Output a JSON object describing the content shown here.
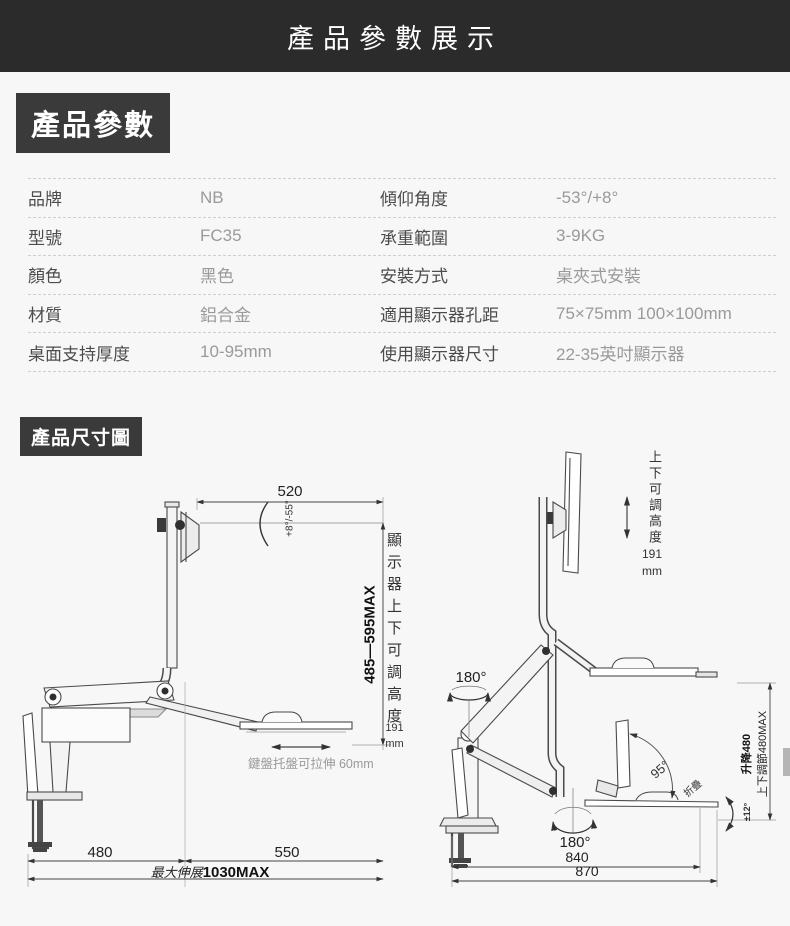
{
  "page": {
    "title": "產品參數展示"
  },
  "sections": {
    "specs_label": "產品參數",
    "dims_label": "產品尺寸圖"
  },
  "specs": {
    "rows": [
      {
        "l1": "品牌",
        "v1": "NB",
        "l2": "傾仰角度",
        "v2": "-53°/+8°"
      },
      {
        "l1": "型號",
        "v1": "FC35",
        "l2": "承重範圍",
        "v2": "3-9KG"
      },
      {
        "l1": "顏色",
        "v1": "黑色",
        "l2": "安裝方式",
        "v2": "桌夾式安裝"
      },
      {
        "l1": "材質",
        "v1": "鋁合金",
        "l2": "適用顯示器孔距",
        "v2": "75×75mm  100×100mm"
      },
      {
        "l1": "桌面支持厚度",
        "v1": "10-95mm",
        "l2": "使用顯示器尺寸",
        "v2": "22-35英吋顯示器"
      }
    ]
  },
  "diagram_left": {
    "dim_top": "520",
    "tilt_angle": "+8°/-55°",
    "height_range": "485—595MAX",
    "height_note": "顯示器上下可調高度",
    "height_value": "191",
    "height_unit": "mm",
    "tray_note": "鍵盤托盤可拉伸 60mm",
    "dim_480": "480",
    "dim_550": "550",
    "max_label": "最大伸展",
    "max_value": "1030MAX"
  },
  "diagram_right": {
    "height_note": "上下可調高度",
    "height_value": "191",
    "height_unit": "mm",
    "swivel_top": "180°",
    "fold_angle": "95°",
    "fold_label": "折疊",
    "swivel_bottom": "180°",
    "dim_840": "840",
    "dim_870": "870",
    "lift_label": "升降480",
    "lift_range": "上下調節480MAX",
    "tilt_small": "±12°"
  },
  "colors": {
    "header_bg": "#2b2b2b",
    "badge_bg": "#3a3a3a",
    "page_bg": "#f7f7f8",
    "label_text": "#4c4c4c",
    "value_text": "#9a9a9a",
    "line_art": "#4a4a4a"
  }
}
